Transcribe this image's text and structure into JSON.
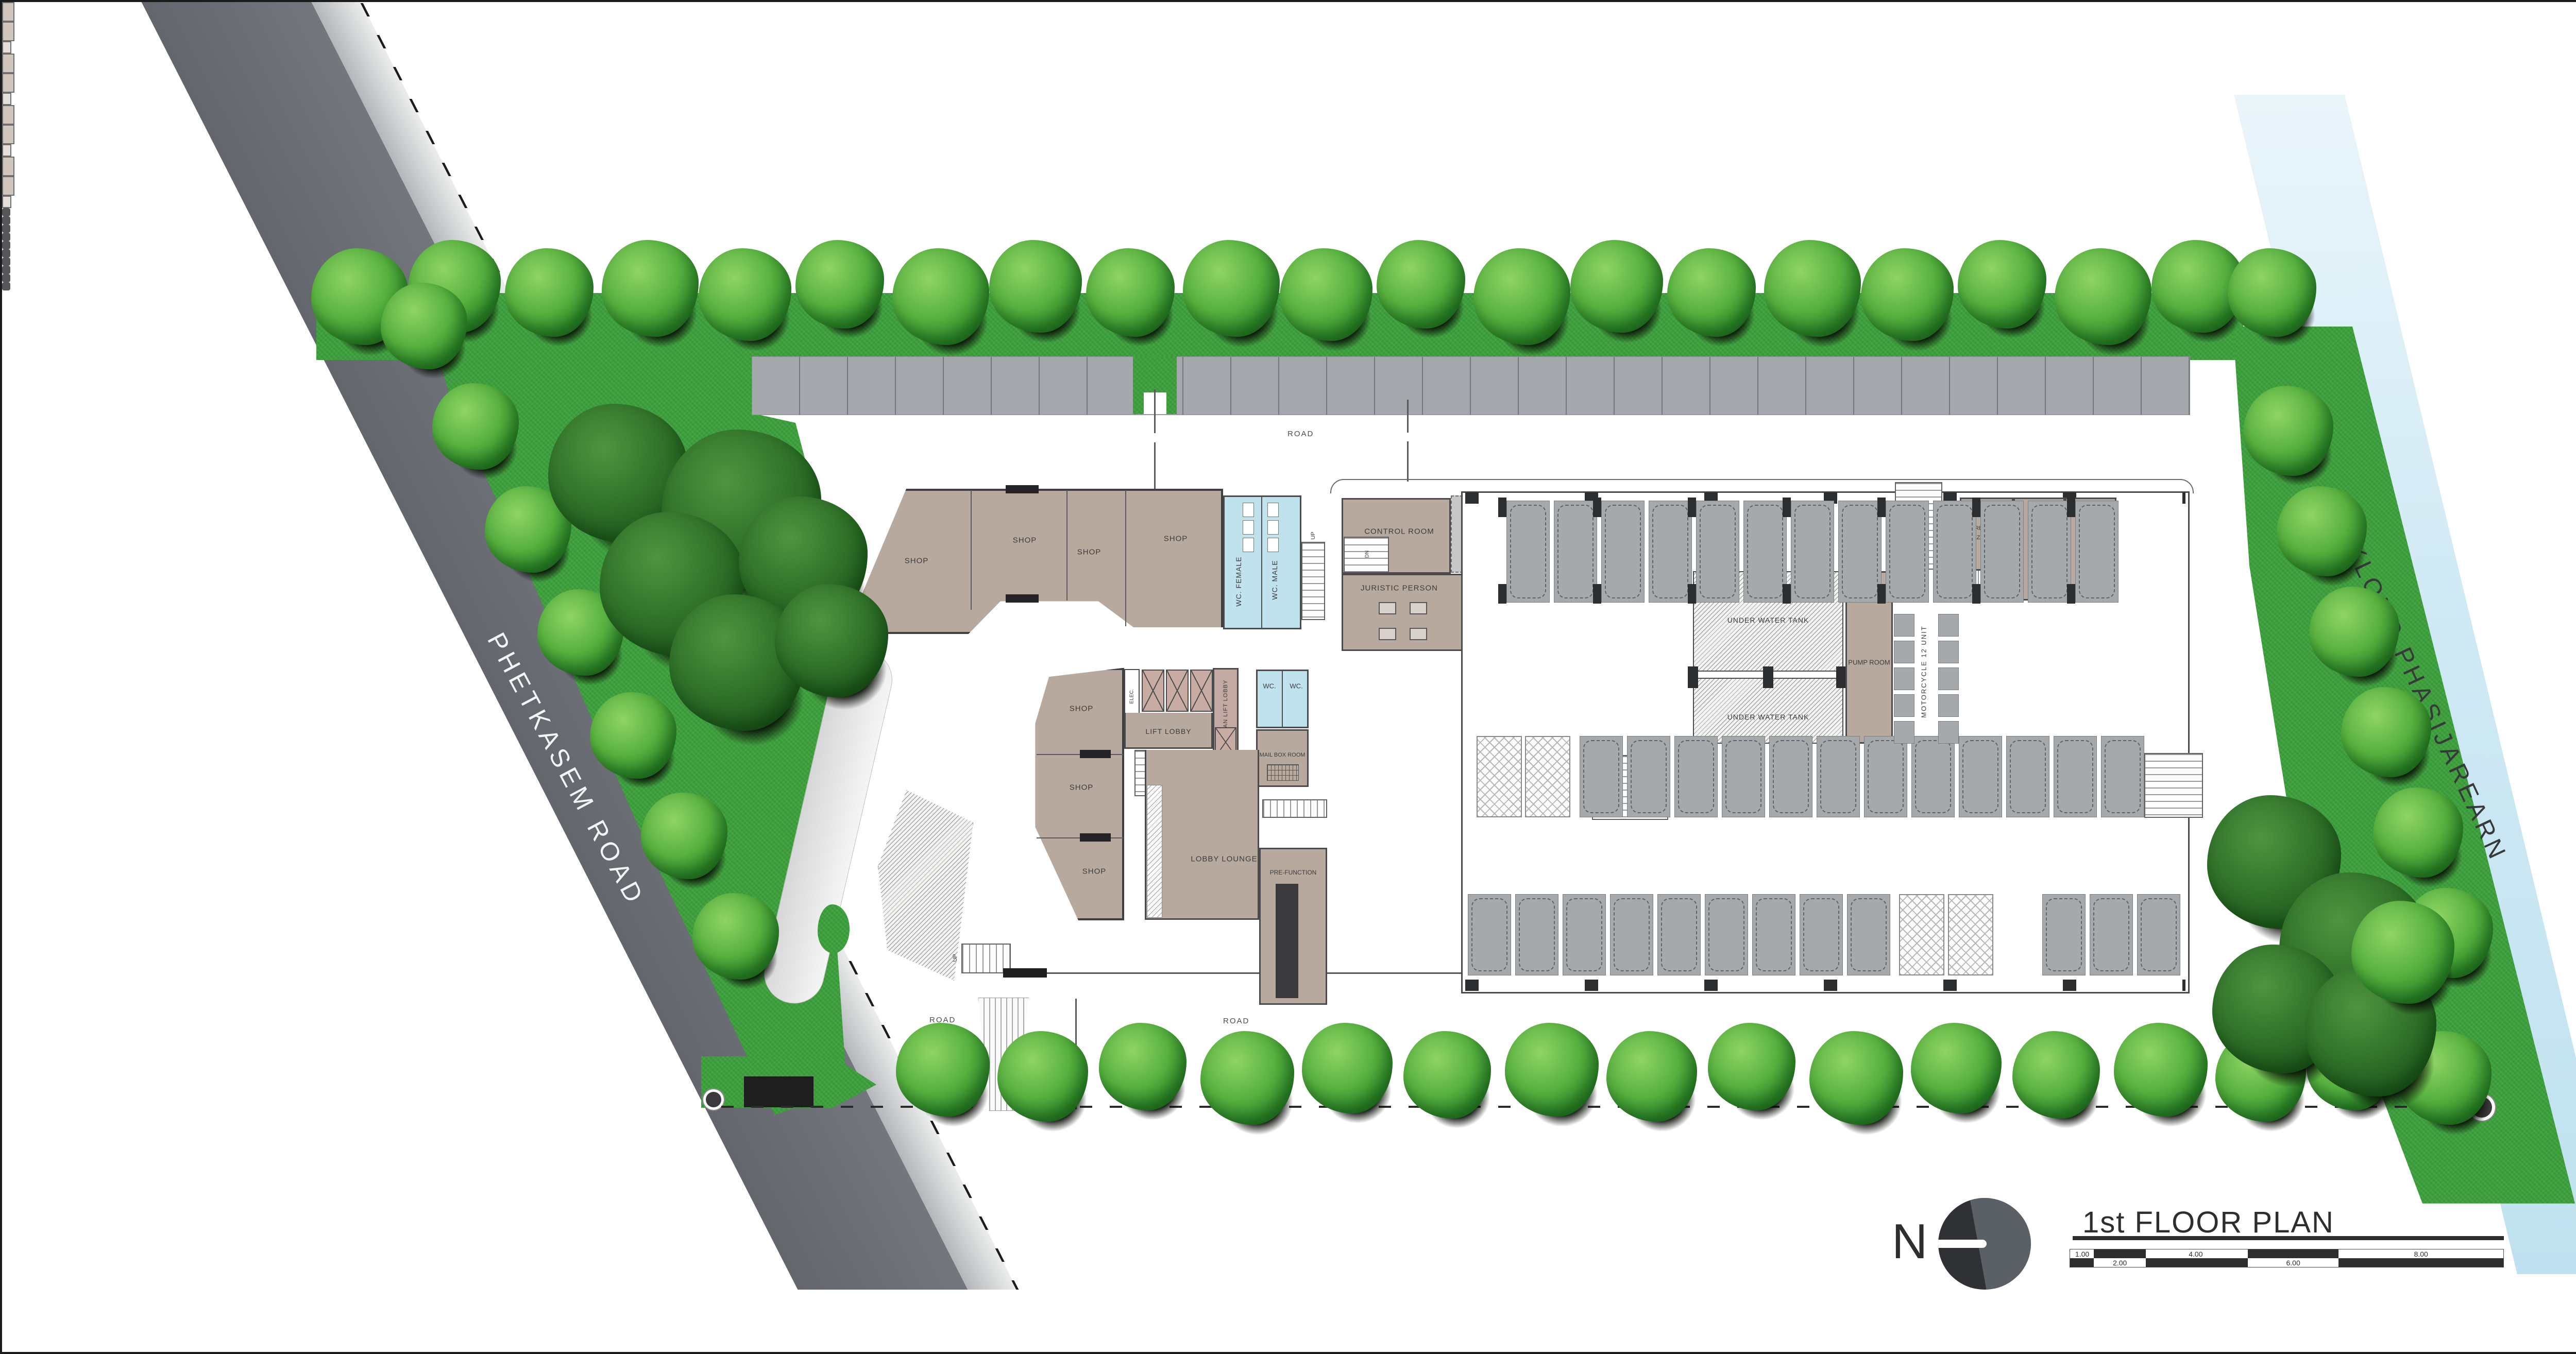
{
  "site": {
    "roads": {
      "left_road": "PHETKASEM ROAD",
      "canal": "KLONG PHASIJAREARN",
      "internal_road": "ROAD"
    },
    "rooms": {
      "shop": "SHOP",
      "wc_female": "WC. FEMALE",
      "wc_male": "WC. MALE",
      "wc": "WC.",
      "control_room": "CONTROL ROOM",
      "juristic_person": "JURISTIC PERSON",
      "elec": "ELEC.",
      "lift_lobby": "LIFT LOBBY",
      "fireman_lift_lobby": "FIREMAN LIFT LOBBY",
      "mail_box_room": "MAIL BOX ROOM",
      "lobby_lounge": "LOBBY LOUNGE",
      "pre_function": "PRE-FUNCTION",
      "under_water_tank": "UNDER WATER TANK",
      "pump_room": "PUMP ROOM",
      "motorcycle": "MOTORCYCLE 12 UNIT",
      "garbage_hazardous_line1": "GARBAGE RM.",
      "garbage_hazardous_line2": "[HAZARDOUS]",
      "garbage_wet": "GARBAGE RM. [WET]",
      "garbage_dry": "GARBAGE RM. [DRY]",
      "up": "UP",
      "dn": "DN"
    }
  },
  "title_block": {
    "north_label": "N",
    "title": "1st FLOOR PLAN",
    "scale_labels": [
      "1.00",
      "2.00",
      "4.00",
      "6.00",
      "8.00"
    ]
  },
  "colors": {
    "road_gray": "#6b6f75",
    "water_blue": "#cfe9f4",
    "grass_green": "#3c9e3b",
    "room_tan": "#b7a99e",
    "wc_blue": "#bfe2ec",
    "stall_gray": "#a6a9ab",
    "line_dark": "#4b4b4d"
  }
}
